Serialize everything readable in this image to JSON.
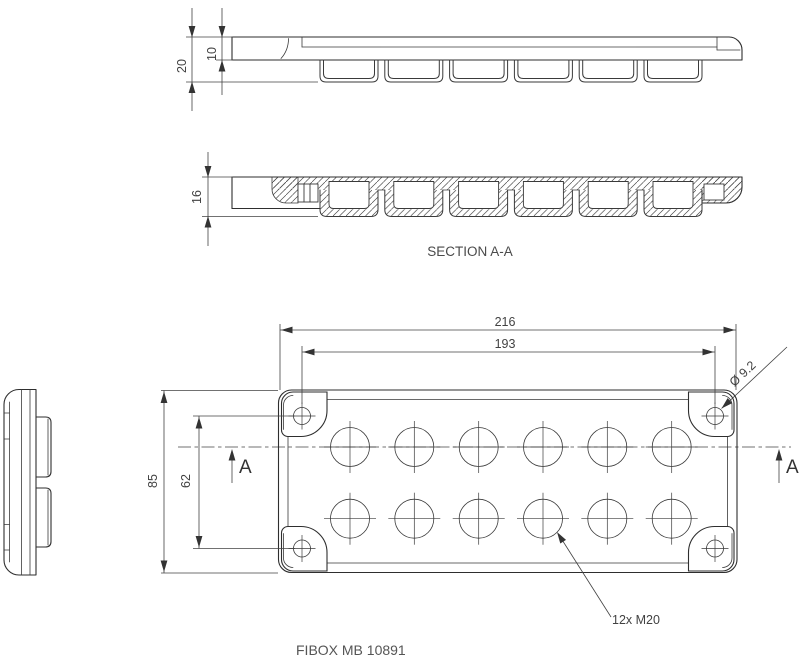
{
  "title": "FIBOX MB 10891",
  "section": {
    "label": "SECTION A-A",
    "marker": "A"
  },
  "dims": {
    "length_outer": "216",
    "length_holes": "193",
    "width_outer": "85",
    "width_holes": "62",
    "height_total": "20",
    "height_cover": "10",
    "height_section": "16",
    "corner_hole_dia": "Ø 9.2",
    "knockouts": "12x M20"
  },
  "features": {
    "knockout_rows": 2,
    "knockouts_per_row": 6,
    "corner_holes": 4
  }
}
